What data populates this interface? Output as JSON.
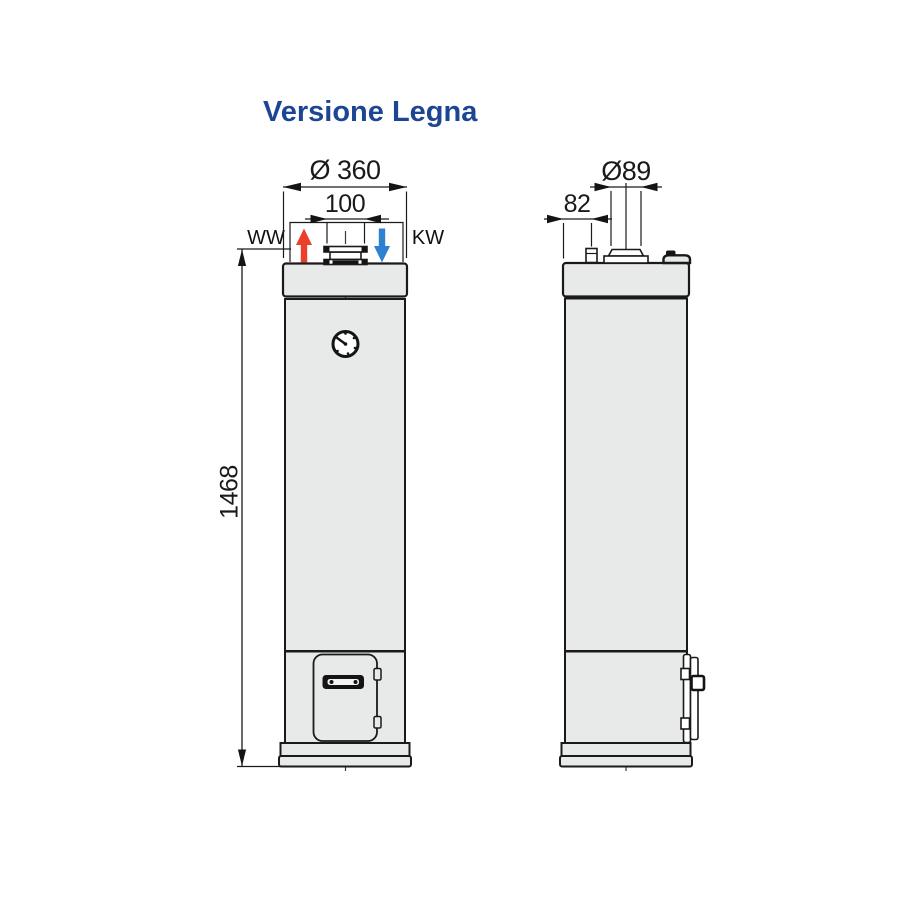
{
  "title": "Versione Legna",
  "colors": {
    "title": "#1c4693",
    "line": "#1a1a1a",
    "tank_fill": "#e8eae9",
    "ww_arrow": "#e8402c",
    "kw_arrow": "#2e80d2"
  },
  "front_view": {
    "dim_diameter": "Ø 360",
    "dim_connections": "100",
    "dim_height": "1468",
    "label_warm_water": "WW",
    "label_cold_water": "KW"
  },
  "side_view": {
    "dim_flue_diameter": "Ø89",
    "dim_flue_offset": "82"
  }
}
